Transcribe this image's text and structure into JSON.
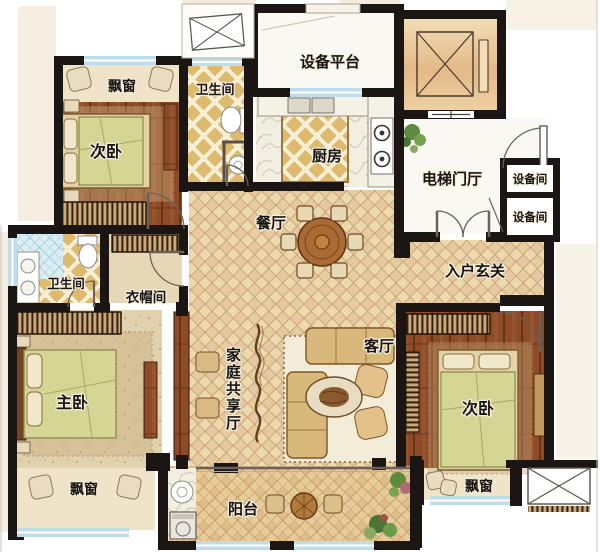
{
  "rooms": {
    "bay_window_top_left": "飘窗",
    "bedroom_top_left": "次卧",
    "bathroom_top": "卫生间",
    "equipment_platform": "设备平台",
    "kitchen": "厨房",
    "elevator_lobby": "电梯门厅",
    "equipment_room_1": "设备间",
    "equipment_room_2": "设备间",
    "dining_room": "餐厅",
    "entry_foyer": "入户玄关",
    "bathroom_master": "卫生间",
    "cloakroom": "衣帽间",
    "master_bedroom": "主卧",
    "family_shared_hall": "家庭共享厅",
    "living_room": "客厅",
    "bedroom_right": "次卧",
    "bay_window_master": "飘窗",
    "bay_window_right": "飘窗",
    "balcony": "阳台"
  },
  "colors": {
    "wall": "#1b1613",
    "floor_tile": "#ecd9ae",
    "wood_floor": "#8d4b27",
    "bath_gold": "#ddba6e",
    "window_glass": "#bedce9",
    "white_room": "#faf8f2",
    "bay_beige": "#efe4c8",
    "blanket_green": "#d5d694",
    "elevator_tan": "#e9c99c"
  }
}
